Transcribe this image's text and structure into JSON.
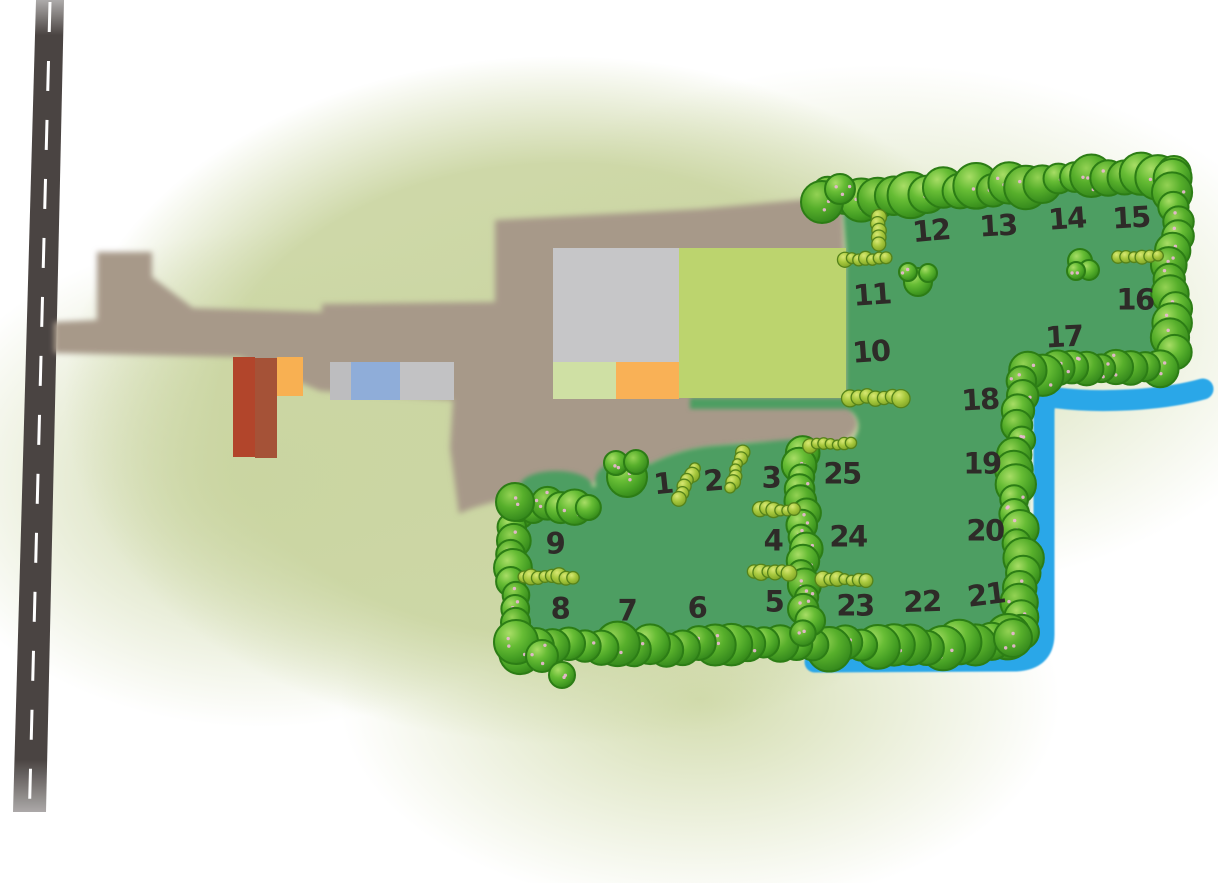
{
  "map": {
    "kind": "campsite-plot-map"
  },
  "pitches": [
    {
      "label": "1",
      "x": 663,
      "y": 484,
      "rot": -6
    },
    {
      "label": "2",
      "x": 713,
      "y": 481,
      "rot": -5
    },
    {
      "label": "3",
      "x": 771,
      "y": 478,
      "rot": 0
    },
    {
      "label": "4",
      "x": 773,
      "y": 541,
      "rot": 0
    },
    {
      "label": "5",
      "x": 774,
      "y": 602,
      "rot": 0
    },
    {
      "label": "6",
      "x": 697,
      "y": 608,
      "rot": 0
    },
    {
      "label": "7",
      "x": 627,
      "y": 611,
      "rot": 0
    },
    {
      "label": "8",
      "x": 560,
      "y": 609,
      "rot": 0
    },
    {
      "label": "9",
      "x": 555,
      "y": 544,
      "rot": 0
    },
    {
      "label": "10",
      "x": 871,
      "y": 352,
      "rot": -4
    },
    {
      "label": "11",
      "x": 872,
      "y": 295,
      "rot": -4
    },
    {
      "label": "12",
      "x": 931,
      "y": 231,
      "rot": -5
    },
    {
      "label": "13",
      "x": 998,
      "y": 226,
      "rot": -3
    },
    {
      "label": "14",
      "x": 1067,
      "y": 219,
      "rot": -4
    },
    {
      "label": "15",
      "x": 1131,
      "y": 218,
      "rot": -3
    },
    {
      "label": "16",
      "x": 1135,
      "y": 300,
      "rot": 0
    },
    {
      "label": "17",
      "x": 1064,
      "y": 337,
      "rot": -3
    },
    {
      "label": "18",
      "x": 980,
      "y": 400,
      "rot": -3
    },
    {
      "label": "19",
      "x": 982,
      "y": 464,
      "rot": 0
    },
    {
      "label": "20",
      "x": 985,
      "y": 531,
      "rot": 0
    },
    {
      "label": "21",
      "x": 986,
      "y": 595,
      "rot": -7
    },
    {
      "label": "22",
      "x": 922,
      "y": 602,
      "rot": -2
    },
    {
      "label": "23",
      "x": 855,
      "y": 606,
      "rot": 0
    },
    {
      "label": "24",
      "x": 848,
      "y": 537,
      "rot": 0
    },
    {
      "label": "25",
      "x": 842,
      "y": 474,
      "rot": 0
    }
  ],
  "palette": {
    "field_green": "#4e9e62",
    "tree_green": "#55ab2e",
    "small_hedge_green": "#a6c73c",
    "stream_blue": "#2ba7e8",
    "path_tan": "#a79989",
    "road_gray": "#4a4442",
    "road_line_white": "#ffffff",
    "building_red_dark": "#b2452b",
    "building_red_light": "#a55237",
    "building_orange": "#f8b052",
    "building_orange_small": "#f9b156",
    "building_gray_left": "#bdbdbf",
    "building_gray_right": "#c2c2c4",
    "building_gray_large": "#c6c6c8",
    "building_blue": "#8fadd9",
    "building_lime": "#bcd46e",
    "building_pale_green": "#cfe0a4",
    "label_color": "#2e2b28"
  }
}
